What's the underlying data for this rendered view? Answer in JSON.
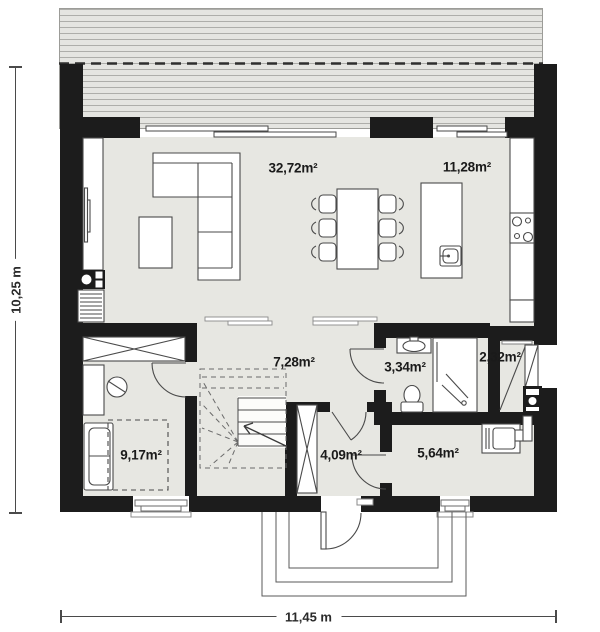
{
  "plan": {
    "type": "ground-floor-plan",
    "rooms": [
      {
        "id": "living-room",
        "area_label": "32,72m²"
      },
      {
        "id": "kitchen-dining",
        "area_label": "11,28m²"
      },
      {
        "id": "hall",
        "area_label": "7,28m²"
      },
      {
        "id": "bathroom",
        "area_label": "3,34m²"
      },
      {
        "id": "storage",
        "area_label": "2,32m²"
      },
      {
        "id": "bedroom",
        "area_label": "9,17m²"
      },
      {
        "id": "vestibule",
        "area_label": "4,09m²"
      },
      {
        "id": "utility",
        "area_label": "5,64m²"
      }
    ],
    "dimensions": {
      "height_label": "10,25 m",
      "width_label": "11,45 m"
    },
    "colors": {
      "wall": "#1c1c1c",
      "floor": "#e7e7e2",
      "terrace_fill": "#e5e5e1",
      "terrace_line": "#aeaeaa",
      "outline": "#4a4a4a",
      "label_text": "#1a1a1a"
    },
    "features": [
      "terrace-deck",
      "roof-overhang-dashed-line",
      "sliding-terrace-doors",
      "tv-wall-unit",
      "fireplace-chimney",
      "radiator",
      "corner-sofa",
      "coffee-table",
      "dining-table-six-chairs",
      "kitchen-island-with-sink",
      "kitchen-counter-with-cooktop",
      "winder-staircase",
      "wardrobe-bedroom",
      "desk",
      "desk-chair",
      "sofa-bed",
      "bed-dashed-outline",
      "washbasin",
      "toilet",
      "shower-cabin",
      "storage-exterior-door",
      "chimney-flue-block",
      "furnace-with-flue-pipe",
      "vestibule-wardrobe",
      "entry-door",
      "entry-steps"
    ]
  }
}
